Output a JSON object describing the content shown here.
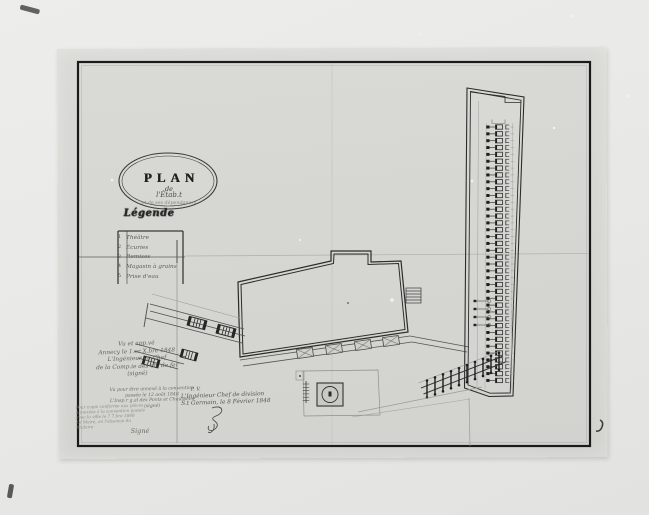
{
  "document": {
    "kind": "photograph of a hand-drawn architectural site plan, dated 1848",
    "colors": {
      "photo_background": "#e8e8e6",
      "paper": "#d6d6d2",
      "frame_ink": "#1b1b1b",
      "drawing_ink": "#2c2c2a",
      "faint_ink": "#8a8a86"
    }
  },
  "title": {
    "word": "PLAN",
    "de": "de",
    "script_line1": "l'Étab.t",
    "script_line2": "et de ses dépendances"
  },
  "legend": {
    "heading": "Légende",
    "items": [
      {
        "num": "1",
        "label": "Théâtre"
      },
      {
        "num": "2",
        "label": "Écuries"
      },
      {
        "num": "3",
        "label": "Remises"
      },
      {
        "num": "4",
        "label": "Magasin à grains"
      },
      {
        "num": "5",
        "label": "Prise d'eau"
      }
    ]
  },
  "annotations": {
    "left_upper": [
      "Vu et app.vé",
      "Annecy le 1.er X.bre 1848",
      "L'Ingénieur en Chef",
      "de la Comp.ie des ch. de fer",
      "(signé)"
    ],
    "left_mid": [
      "Vu pour être annexé à la convention",
      "passée le 12 août 1848",
      "L'Insp.r g.al des Ponts et Chaussées",
      "(signé)"
    ],
    "left_lower": [
      "Pour copie conforme aux pièces",
      "annexées à la convention passée",
      "avec la ville le 7 7.bre 1848",
      "Le Maire, en l'absence du",
      "titulaire"
    ],
    "left_lower_sig": "Signé",
    "center": [
      "P. V.",
      "L'Ingénieur Chef de division",
      "S.t Germain, le 8 Février 1848"
    ]
  },
  "drawing": {
    "stall_rows": 38,
    "extra_stall_marks": 4,
    "comb_teeth": 10,
    "platform_huts": 4
  }
}
